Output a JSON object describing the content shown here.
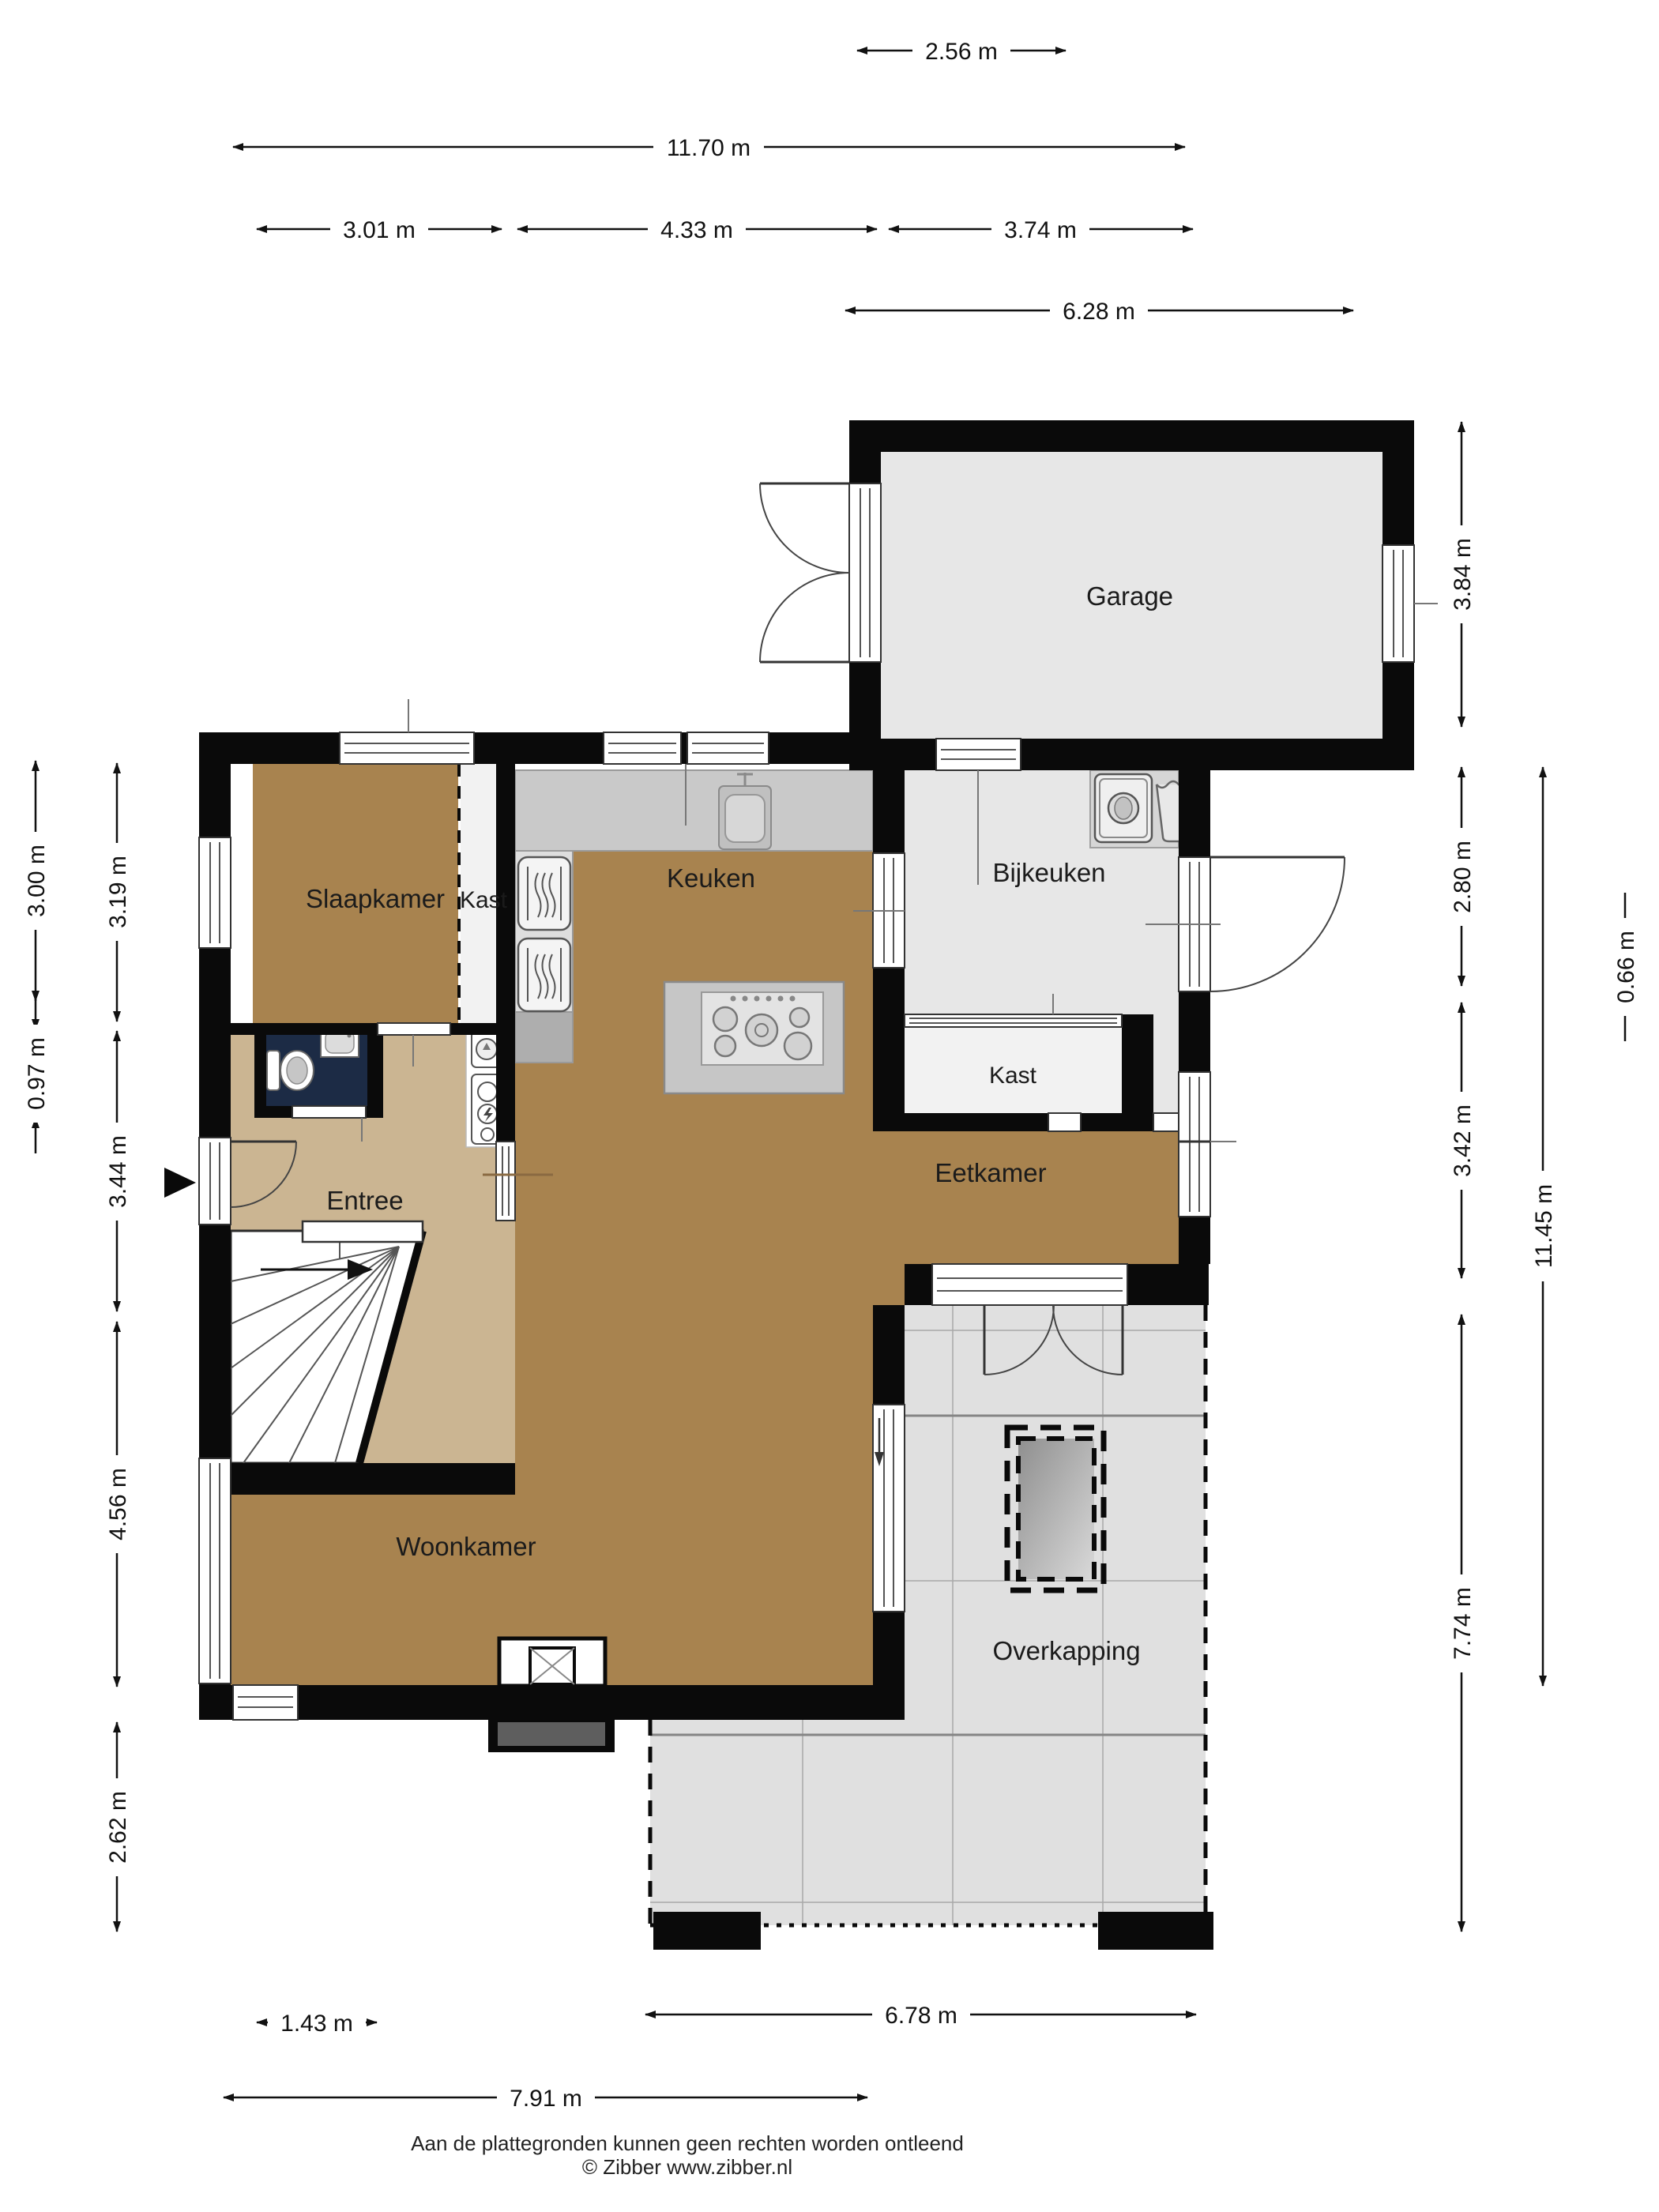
{
  "fp": {
    "rooms": {
      "garage": "Garage",
      "bijkeuken": "Bijkeuken",
      "kast_bijkeuken": "Kast",
      "keuken": "Keuken",
      "slaapkamer": "Slaapkamer",
      "kast_slaapkamer": "Kast",
      "entree": "Entree",
      "eetkamer": "Eetkamer",
      "woonkamer": "Woonkamer",
      "overkapping": "Overkapping"
    },
    "dims_top": {
      "d256": "2.56 m",
      "d1170": "11.70 m",
      "d301": "3.01 m",
      "d433": "4.33 m",
      "d374": "3.74 m",
      "d628": "6.28 m"
    },
    "dims_left": {
      "d300": "3.00 m",
      "d319": "3.19 m",
      "d097": "0.97 m",
      "d344": "3.44 m",
      "d456": "4.56 m",
      "d262": "2.62 m"
    },
    "dims_right": {
      "d384": "3.84 m",
      "d280": "2.80 m",
      "d066": "0.66 m",
      "d342": "3.42 m",
      "d1145": "11.45 m",
      "d774": "7.74 m"
    },
    "dims_bottom": {
      "d143": "1.43 m",
      "d678": "6.78 m",
      "d791": "7.91 m"
    },
    "footer": {
      "line1": "Aan de plattegronden kunnen geen rechten worden ontleend",
      "line2": "© Zibber www.zibber.nl"
    },
    "colors": {
      "wall": "#0a0a0a",
      "living_floor": "#a8834f",
      "entree_floor": "#cbb592",
      "gray_floor": "#e7e7e7",
      "kast_floor": "#f2f2f2",
      "toilet_floor": "#1c2b45",
      "counter": "#c9c9c9",
      "tile": "#e0e0e0"
    }
  }
}
